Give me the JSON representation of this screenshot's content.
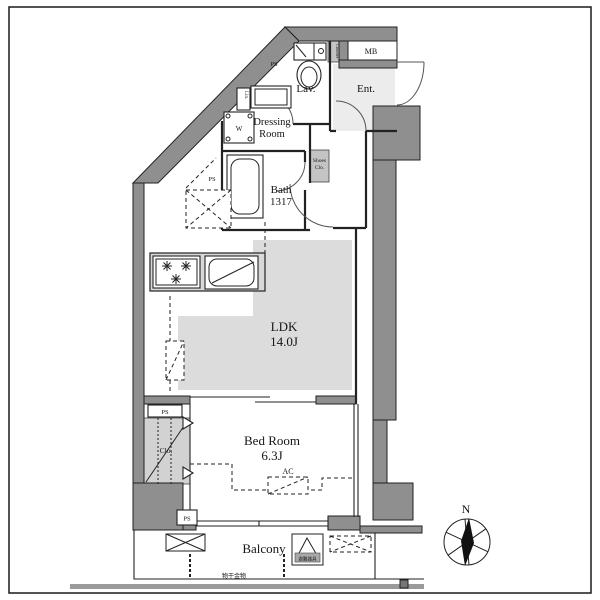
{
  "colors": {
    "wall": "#8f8f8f",
    "line": "#222222",
    "floor": "#dcdcdc",
    "entfloor": "#ececec",
    "clofloor": "#d2d2d2",
    "shoes": "#c4c4c4",
    "kitchen": "#d8d8d8",
    "band": "#9a9a9a"
  },
  "rooms": {
    "ldk_name": "LDK",
    "ldk_size": "14.0J",
    "bedroom_name": "Bed Room",
    "bedroom_size": "6.3J",
    "bath_name": "Bath",
    "bath_size": "1317",
    "dressing_line1": "Dressing",
    "dressing_line2": "Room",
    "lav": "Lav.",
    "ent": "Ent.",
    "balcony": "Balcony"
  },
  "labels": {
    "mb": "MB",
    "counter": "Counter",
    "linen": "Lin.",
    "washer": "W",
    "shoes_line1": "Shoes",
    "shoes_line2": "Clo.",
    "closet": "Clo.",
    "ac": "AC",
    "ps": "PS",
    "evac_hatch": "避難器具",
    "laundry_fitting": "物干金物",
    "compass_north": "N"
  }
}
